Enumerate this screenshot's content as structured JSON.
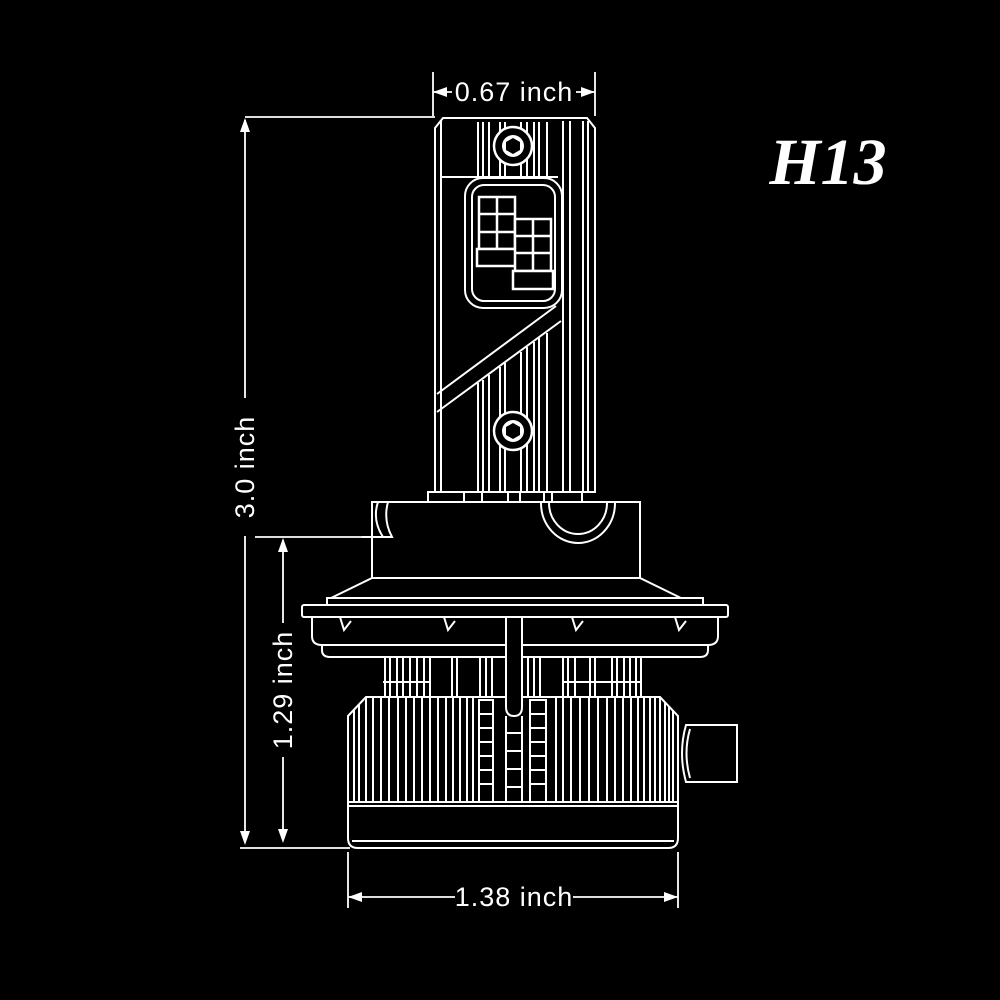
{
  "part_label": "H13",
  "colors": {
    "background": "#000000",
    "line": "#ffffff",
    "text": "#ffffff"
  },
  "dimensions": {
    "top_width": "0.67 inch",
    "overall_height": "3.0 inch",
    "lower_height": "1.29 inch",
    "base_width": "1.38 inch"
  }
}
